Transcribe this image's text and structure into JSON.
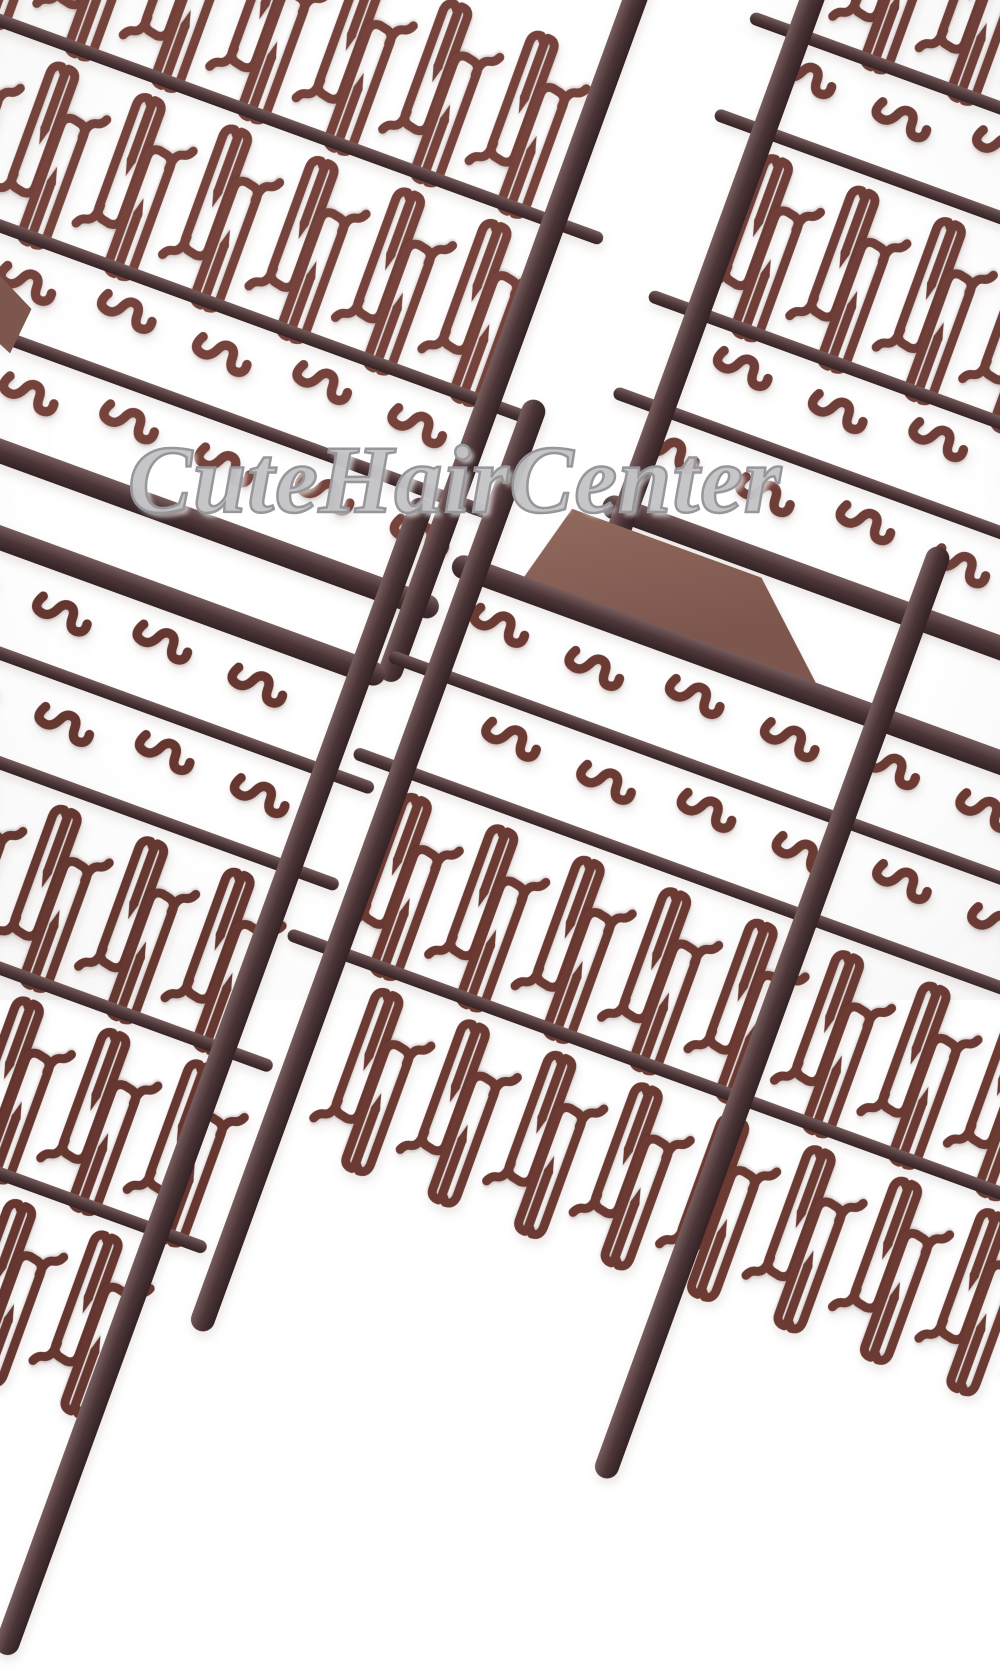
{
  "meta": {
    "type": "product-photo",
    "description": "Four dark brown plastic injection-moulded sprue sheets holding small hair-extension stopper clips (long needle-loop pieces) and small V-shaped clips, arranged diagonally on a plain white background",
    "piece_types": {
      "j": "long-stopper-clip",
      "v": "small-v-clip"
    }
  },
  "watermark": {
    "text": "CuteHairCenter"
  },
  "colors": {
    "bg": "#ffffff",
    "rail": "#4b3537",
    "rail_hi": "#775d5e",
    "rail_dark": "#332224",
    "piece": "#6f3e38",
    "tab": "#7d564e",
    "tab_hi": "#926a5e",
    "wm_stroke": "#96969b",
    "wm_fill": "rgba(255,255,255,0.40)"
  },
  "scene": {
    "rotation_deg": 20,
    "edge_tab": {
      "left": -14,
      "top": 280,
      "width": 42,
      "height": 70
    },
    "panels": [
      {
        "name": "top-left",
        "left": -350,
        "top": -300,
        "width": 1040,
        "height": 610,
        "piece_color": "#75433c",
        "rails": [
          "right"
        ],
        "rows": [
          {
            "kind": "jrow",
            "count": 11
          },
          {
            "kind": "bar"
          },
          {
            "kind": "jrow",
            "count": 11,
            "dx": 20
          },
          {
            "kind": "bar"
          },
          {
            "kind": "vrow",
            "count": 10
          },
          {
            "kind": "bar"
          },
          {
            "kind": "vrow",
            "count": 10,
            "dx": 40
          },
          {
            "kind": "rail"
          }
        ]
      },
      {
        "name": "top-right",
        "left": 850,
        "top": -140,
        "width": 760,
        "height": 740,
        "piece_color": "#6f3e38",
        "rails": [
          "left"
        ],
        "rows": [
          {
            "kind": "jrow",
            "count": 8,
            "dx": 30
          },
          {
            "kind": "bar"
          },
          {
            "kind": "vrow",
            "count": 7
          },
          {
            "kind": "bar"
          },
          {
            "kind": "jrow",
            "count": 8
          },
          {
            "kind": "bar"
          },
          {
            "kind": "vrow",
            "count": 7,
            "dx": 40
          },
          {
            "kind": "bar"
          },
          {
            "kind": "vrow",
            "count": 7
          },
          {
            "kind": "rail"
          }
        ]
      },
      {
        "name": "bottom-left",
        "left": -55,
        "top": 505,
        "width": 460,
        "height": 1000,
        "piece_color": "#653730",
        "rails": [
          "right"
        ],
        "rows": [
          {
            "kind": "rail"
          },
          {
            "kind": "vrow",
            "count": 4,
            "dx": 10
          },
          {
            "kind": "bar"
          },
          {
            "kind": "vrow",
            "count": 4,
            "dx": 50
          },
          {
            "kind": "bar"
          },
          {
            "kind": "jrow",
            "count": 5
          },
          {
            "kind": "bar"
          },
          {
            "kind": "jrow",
            "count": 5,
            "dx": 30
          },
          {
            "kind": "bar"
          },
          {
            "kind": "jrow",
            "count": 5
          }
        ]
      },
      {
        "name": "bottom-right",
        "left": 468,
        "top": 556,
        "width": 860,
        "height": 760,
        "piece_color": "#6b3a33",
        "rails": [
          "left"
        ],
        "inner_rails": [
          430
        ],
        "tab": {
          "x": 60,
          "y": -80,
          "w": 310,
          "h": 80
        },
        "rows": [
          {
            "kind": "rail"
          },
          {
            "kind": "vrow",
            "count": 8,
            "dx": 20
          },
          {
            "kind": "bar"
          },
          {
            "kind": "vrow",
            "count": 8,
            "dx": 70
          },
          {
            "kind": "bar"
          },
          {
            "kind": "jrow",
            "count": 9
          },
          {
            "kind": "bar"
          },
          {
            "kind": "jrow",
            "count": 9,
            "dx": 40
          }
        ]
      }
    ]
  }
}
